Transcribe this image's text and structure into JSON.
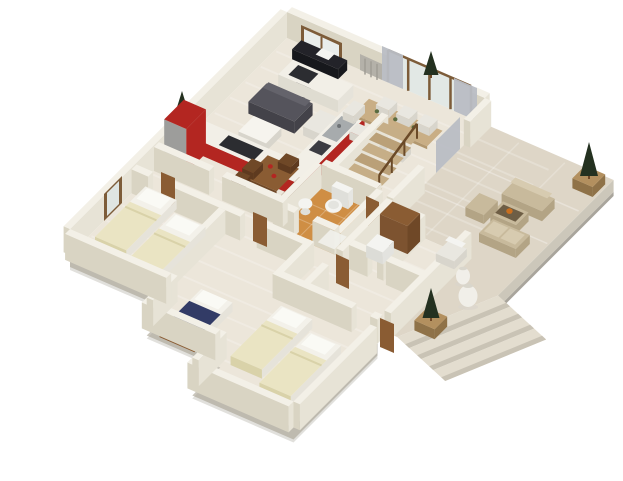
{
  "scene": {
    "type": "3d-isometric-floorplan-render",
    "background": "#ffffff",
    "palette": {
      "wallTop": "#f3f0e7",
      "wallFaceLit": "#e7e3d6",
      "wallFaceShade": "#d9d4c3",
      "plinth": "#c9c5bb",
      "plinthDark": "#a9a59c",
      "floorHouse": "#ece6da",
      "floorBath": "#cf8e44",
      "floorDeck": "#ded6c7",
      "deckEdge": "#ccc7ba",
      "stepTop": "#e3ddcf",
      "stepFace": "#c9c3b5",
      "kitchenRed": "#b32621",
      "kitchenRedDark": "#971f1a",
      "counterTop": "#f2efe7",
      "fridgeGray": "#9d9d9b",
      "sinkGray": "#a7abad",
      "cooktopDark": "#2c2d31",
      "tvBlack": "#17181c",
      "consoleBlack": "#232329",
      "sofaGray": "#55545c",
      "sofaGrayDark": "#434249",
      "rugWhite": "#f6f4ee",
      "chairWhite": "#e9e7e0",
      "chairWhiteDark": "#d8d5cc",
      "tableWood": "#c9ae85",
      "tableWoodDark": "#b2976e",
      "woodMid": "#7d5c39",
      "doorBrown": "#8a5c33",
      "doorBrownDark": "#6f4827",
      "stairTread": "#c6ae87",
      "stairTreadAlt": "#baa078",
      "railWood": "#6b4a28",
      "fixtureWhite": "#f4f4f1",
      "matWhite": "#f1f1ec",
      "bedBase": "#f3f1ea",
      "bedBaseLit": "#e6e3da",
      "bedBaseShade": "#dfdcd1",
      "bedCream": "#eae4c3",
      "bedCreamEdge": "#d9d2a9",
      "pillowWhite": "#fafaf5",
      "bedNavy": "#323b66",
      "bedNavyDark": "#272e52",
      "curtainGray": "#b9bdc4",
      "glass": "#e9edeb",
      "glassDim": "#dfe5e2",
      "radiator": "#b4b1a9",
      "radiatorSlat": "#a09d95",
      "treeGreen": "#243120",
      "planterWood": "#b3905f",
      "planterWoodDark": "#8f7248",
      "outdoorTan": "#c8ba9c",
      "outdoorTanDark": "#b3a485",
      "outdoorCushion": "#d7cbb0",
      "outdoorTop": "#6e5e45",
      "accentOrange": "#c96f1f",
      "vaseWhite": "#f1efe9",
      "shadowSoft": "#d8d4cb"
    },
    "rooms": [
      "living-room",
      "kitchen",
      "dining-area",
      "hallway",
      "bathroom",
      "bedroom-left",
      "bedroom-middle",
      "bedroom-bottom",
      "en-suite",
      "deck-terrace",
      "staircase"
    ],
    "furniture": [
      "wall-tv",
      "tv-console",
      "gray-sofa",
      "kitchen-island",
      "coffee-table",
      "armchair",
      "red-kitchen-counter",
      "red-refrigerator",
      "cooktop",
      "sink",
      "long-dining-table",
      "white-dining-chairs",
      "square-wood-table",
      "wood-chairs",
      "staircase-treads",
      "stair-railing",
      "toilet",
      "wash-basin",
      "bath-mat",
      "single-bed-cream-1",
      "single-bed-cream-2",
      "bed-navy",
      "single-bed-cream-3",
      "single-bed-cream-4",
      "wardrobe",
      "open-doors",
      "window",
      "radiator",
      "curtain-panels",
      "french-doors",
      "outdoor-sofa",
      "outdoor-table",
      "outdoor-bench",
      "outdoor-chair",
      "white-deck-chair",
      "white-vases",
      "potted-tree-planters",
      "deck-steps"
    ]
  }
}
